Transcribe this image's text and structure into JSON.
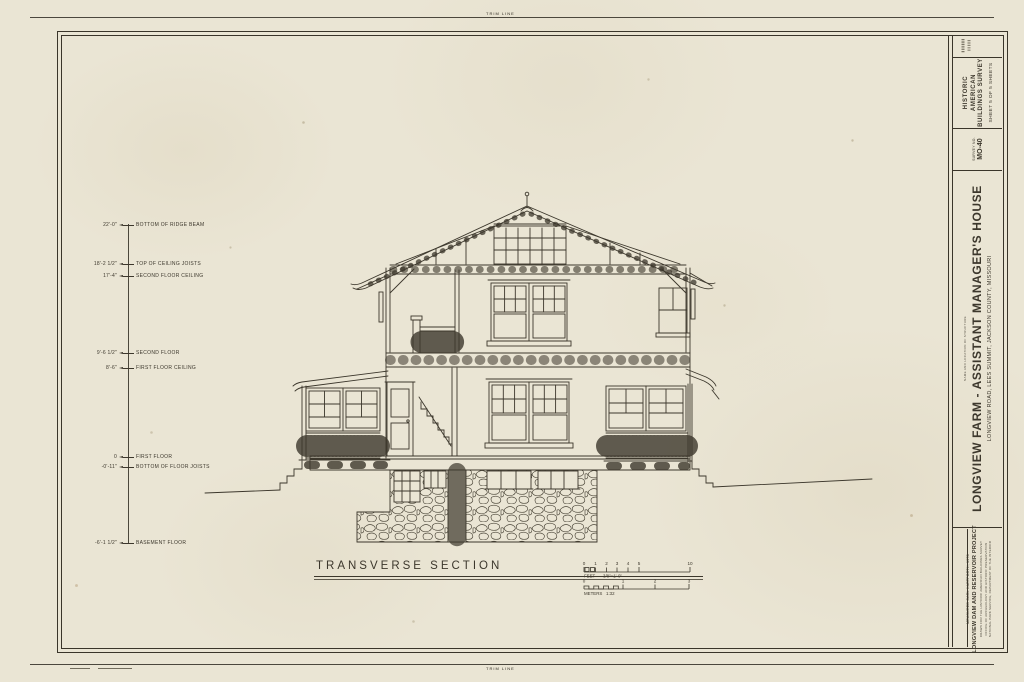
{
  "sheet": {
    "trim_top": "TRIM LINE",
    "trim_bottom": "TRIM LINE"
  },
  "drawing": {
    "title": "TRANSVERSE SECTION"
  },
  "elevation": {
    "items": [
      {
        "y": 225,
        "value": "22'-0\"",
        "label": "BOTTOM OF RIDGE BEAM"
      },
      {
        "y": 264,
        "value": "18'-2 1/2\"",
        "label": "TOP OF CEILING JOISTS"
      },
      {
        "y": 276,
        "value": "17'-4\"",
        "label": "SECOND FLOOR CEILING"
      },
      {
        "y": 353,
        "value": "9'-6 1/2\"",
        "label": "SECOND FLOOR"
      },
      {
        "y": 368,
        "value": "8'-6\"",
        "label": "FIRST FLOOR CEILING"
      },
      {
        "y": 457,
        "value": "0",
        "label": "FIRST FLOOR"
      },
      {
        "y": 467,
        "value": "-0'-11\"",
        "label": "BOTTOM OF FLOOR JOISTS"
      },
      {
        "y": 543,
        "value": "-6'-1 1/2\"",
        "label": "BASEMENT FLOOR"
      }
    ]
  },
  "scalebar": {
    "feet_label": "FEET",
    "feet_note": "3/8\"=1'-0\"",
    "feet_ticks": [
      "0",
      "1",
      "2",
      "3",
      "4",
      "5",
      "10"
    ],
    "meters_label": "METERS",
    "meters_note": "1:32",
    "meters_ticks": [
      "0",
      "1",
      "2",
      "3"
    ]
  },
  "titleblock": {
    "habs_line1": "HISTORIC AMERICAN",
    "habs_line2": "BUILDINGS SURVEY",
    "sheet_info": "SHEET 5 OF 5 SHEETS",
    "survey_label": "SURVEY NO.",
    "survey_no": "MO-40",
    "name_caption": "NAME AND LOCATION OF STRUCTURE",
    "title": "LONGVIEW FARM - ASSISTANT MANAGER'S HOUSE",
    "subtitle": "LONGVIEW ROAD, LEES SUMMIT, JACKSON COUNTY, MISSOURI",
    "credit": "MEASURED CARL HARTFORTH, 1978",
    "project": "LONGVIEW DAM AND RESERVOIR PROJECT",
    "fine1": "DRAWN FOR THE HISTORIC AMERICAN BUILDINGS SURVEY",
    "fine2": "OFFICE OF ARCHEOLOGY AND HISTORIC PRESERVATION",
    "fine3": "NATIONAL PARK SERVICE, DEPARTMENT OF THE INTERIOR"
  },
  "colors": {
    "ink": "#3c372c",
    "paper": "#eae5d4"
  }
}
